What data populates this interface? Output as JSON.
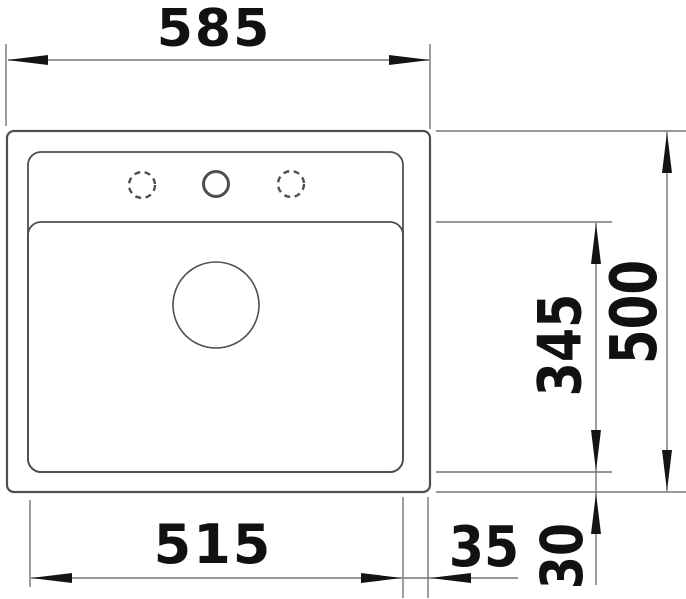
{
  "drawing": {
    "type": "technical-dimension-drawing",
    "subject": "kitchen sink built-in, top view",
    "units": "mm",
    "dimensions": {
      "overall_width": {
        "label": "585",
        "value": 585
      },
      "overall_depth": {
        "label": "500",
        "value": 500
      },
      "bowl_width": {
        "label": "515",
        "value": 515
      },
      "bowl_depth": {
        "label": "345",
        "value": 345
      },
      "bowl_side_offset": {
        "label": "35",
        "value": 35
      },
      "bowl_front_offset": {
        "label": "30",
        "value": 30
      }
    },
    "features": {
      "tap_holes_total": 3,
      "tap_holes_dashed_optional": 2,
      "tap_holes_drilled": 1,
      "drain_holes": 1
    },
    "colors": {
      "background": "#ffffff",
      "outline": "#4f4f4f",
      "dimension_line": "#757575",
      "arrow": "#141414",
      "text": "#111111"
    }
  }
}
